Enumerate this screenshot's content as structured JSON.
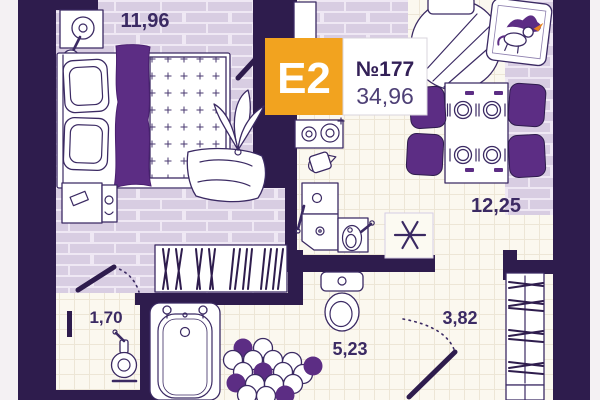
{
  "floorplan": {
    "badge": {
      "layout_type": "E2",
      "unit_number": "№177",
      "total_area": "34,96"
    },
    "rooms": {
      "bedroom": {
        "area": "11,96"
      },
      "kitchen_living": {
        "area": "12,25"
      },
      "wc": {
        "area": "1,70"
      },
      "bathroom": {
        "area": "5,23"
      },
      "hallway": {
        "area": "3,82"
      }
    },
    "colors": {
      "background": "#f4f1f3",
      "wall": "#2e1c4d",
      "floor_lavender": "#d8cde2",
      "floor_cream": "#fbf8ef",
      "accent_purple": "#5c2d84",
      "badge_orange": "#f2a31f",
      "label_text": "#3b2a63",
      "badge_text": "#ffffff",
      "horn_orange": "#e8821e"
    },
    "icons": {
      "bedroom": [
        "table-lamp-icon",
        "double-bed-icon",
        "pillow-icon",
        "tufted-duvet-icon",
        "curtain-throw-icon",
        "plant-icon",
        "blanket-icon",
        "nightstand-icon",
        "wardrobe-hangers-icon"
      ],
      "kitchen": [
        "balcony-door-icon",
        "sofa-rug-icon",
        "unicorn-picture-icon",
        "dining-table-icon",
        "plate-icon",
        "chair-icon",
        "stove-icon",
        "kettle-icon",
        "kitchen-cabinet-icon",
        "kitchen-sink-icon",
        "cooktop-star-icon"
      ],
      "bathroom": [
        "bathtub-icon",
        "toilet-icon",
        "penny-tile-rug-icon"
      ],
      "wc": [
        "wash-basin-icon"
      ],
      "hallway": [
        "entry-wardrobe-icon",
        "door-swing-icon"
      ]
    }
  }
}
